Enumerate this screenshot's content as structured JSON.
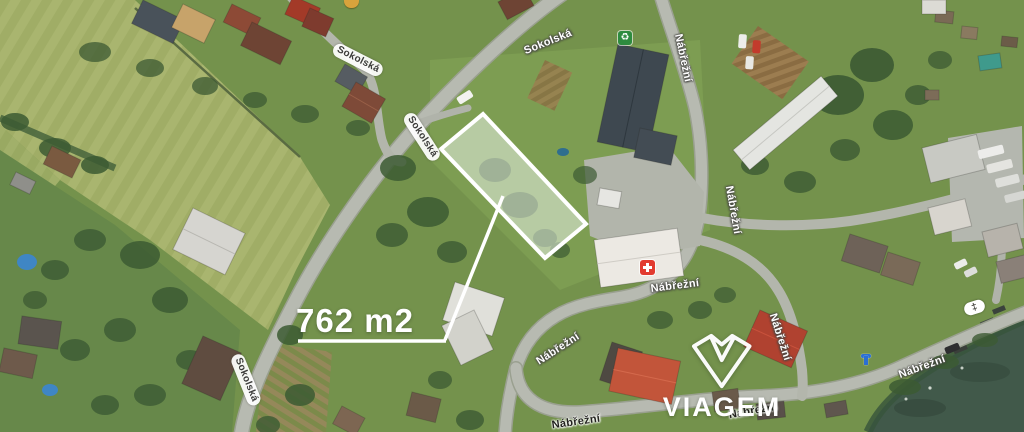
{
  "page": {
    "type": "aerial-property-map"
  },
  "plot": {
    "area_label": "762 m2"
  },
  "streets": {
    "sokolska": "Sokolská",
    "nabrezni": "Nábřežní"
  },
  "watermark": {
    "brand": "VIAGEM"
  },
  "icons": {
    "medical": "medical-cross-icon",
    "recycling": "recycling-icon",
    "recycling_glyph": "♻",
    "hydrant": "hydrant-icon",
    "weir": "weir-icon",
    "weir_glyph": "‡",
    "poi_top": "poi-icon"
  },
  "colors": {
    "plot_outline": "#ffffff",
    "plot_fill": "rgba(232,240,230,0.55)",
    "area_text": "#ffffff",
    "watermark_text": "#ffffff",
    "medical_red": "#e23b30",
    "recycling_green": "#2e8b3f",
    "hydrant_blue": "#2a6fd4",
    "water": "#41594a",
    "road": "#b7bab1",
    "field": "#a9b56f"
  }
}
